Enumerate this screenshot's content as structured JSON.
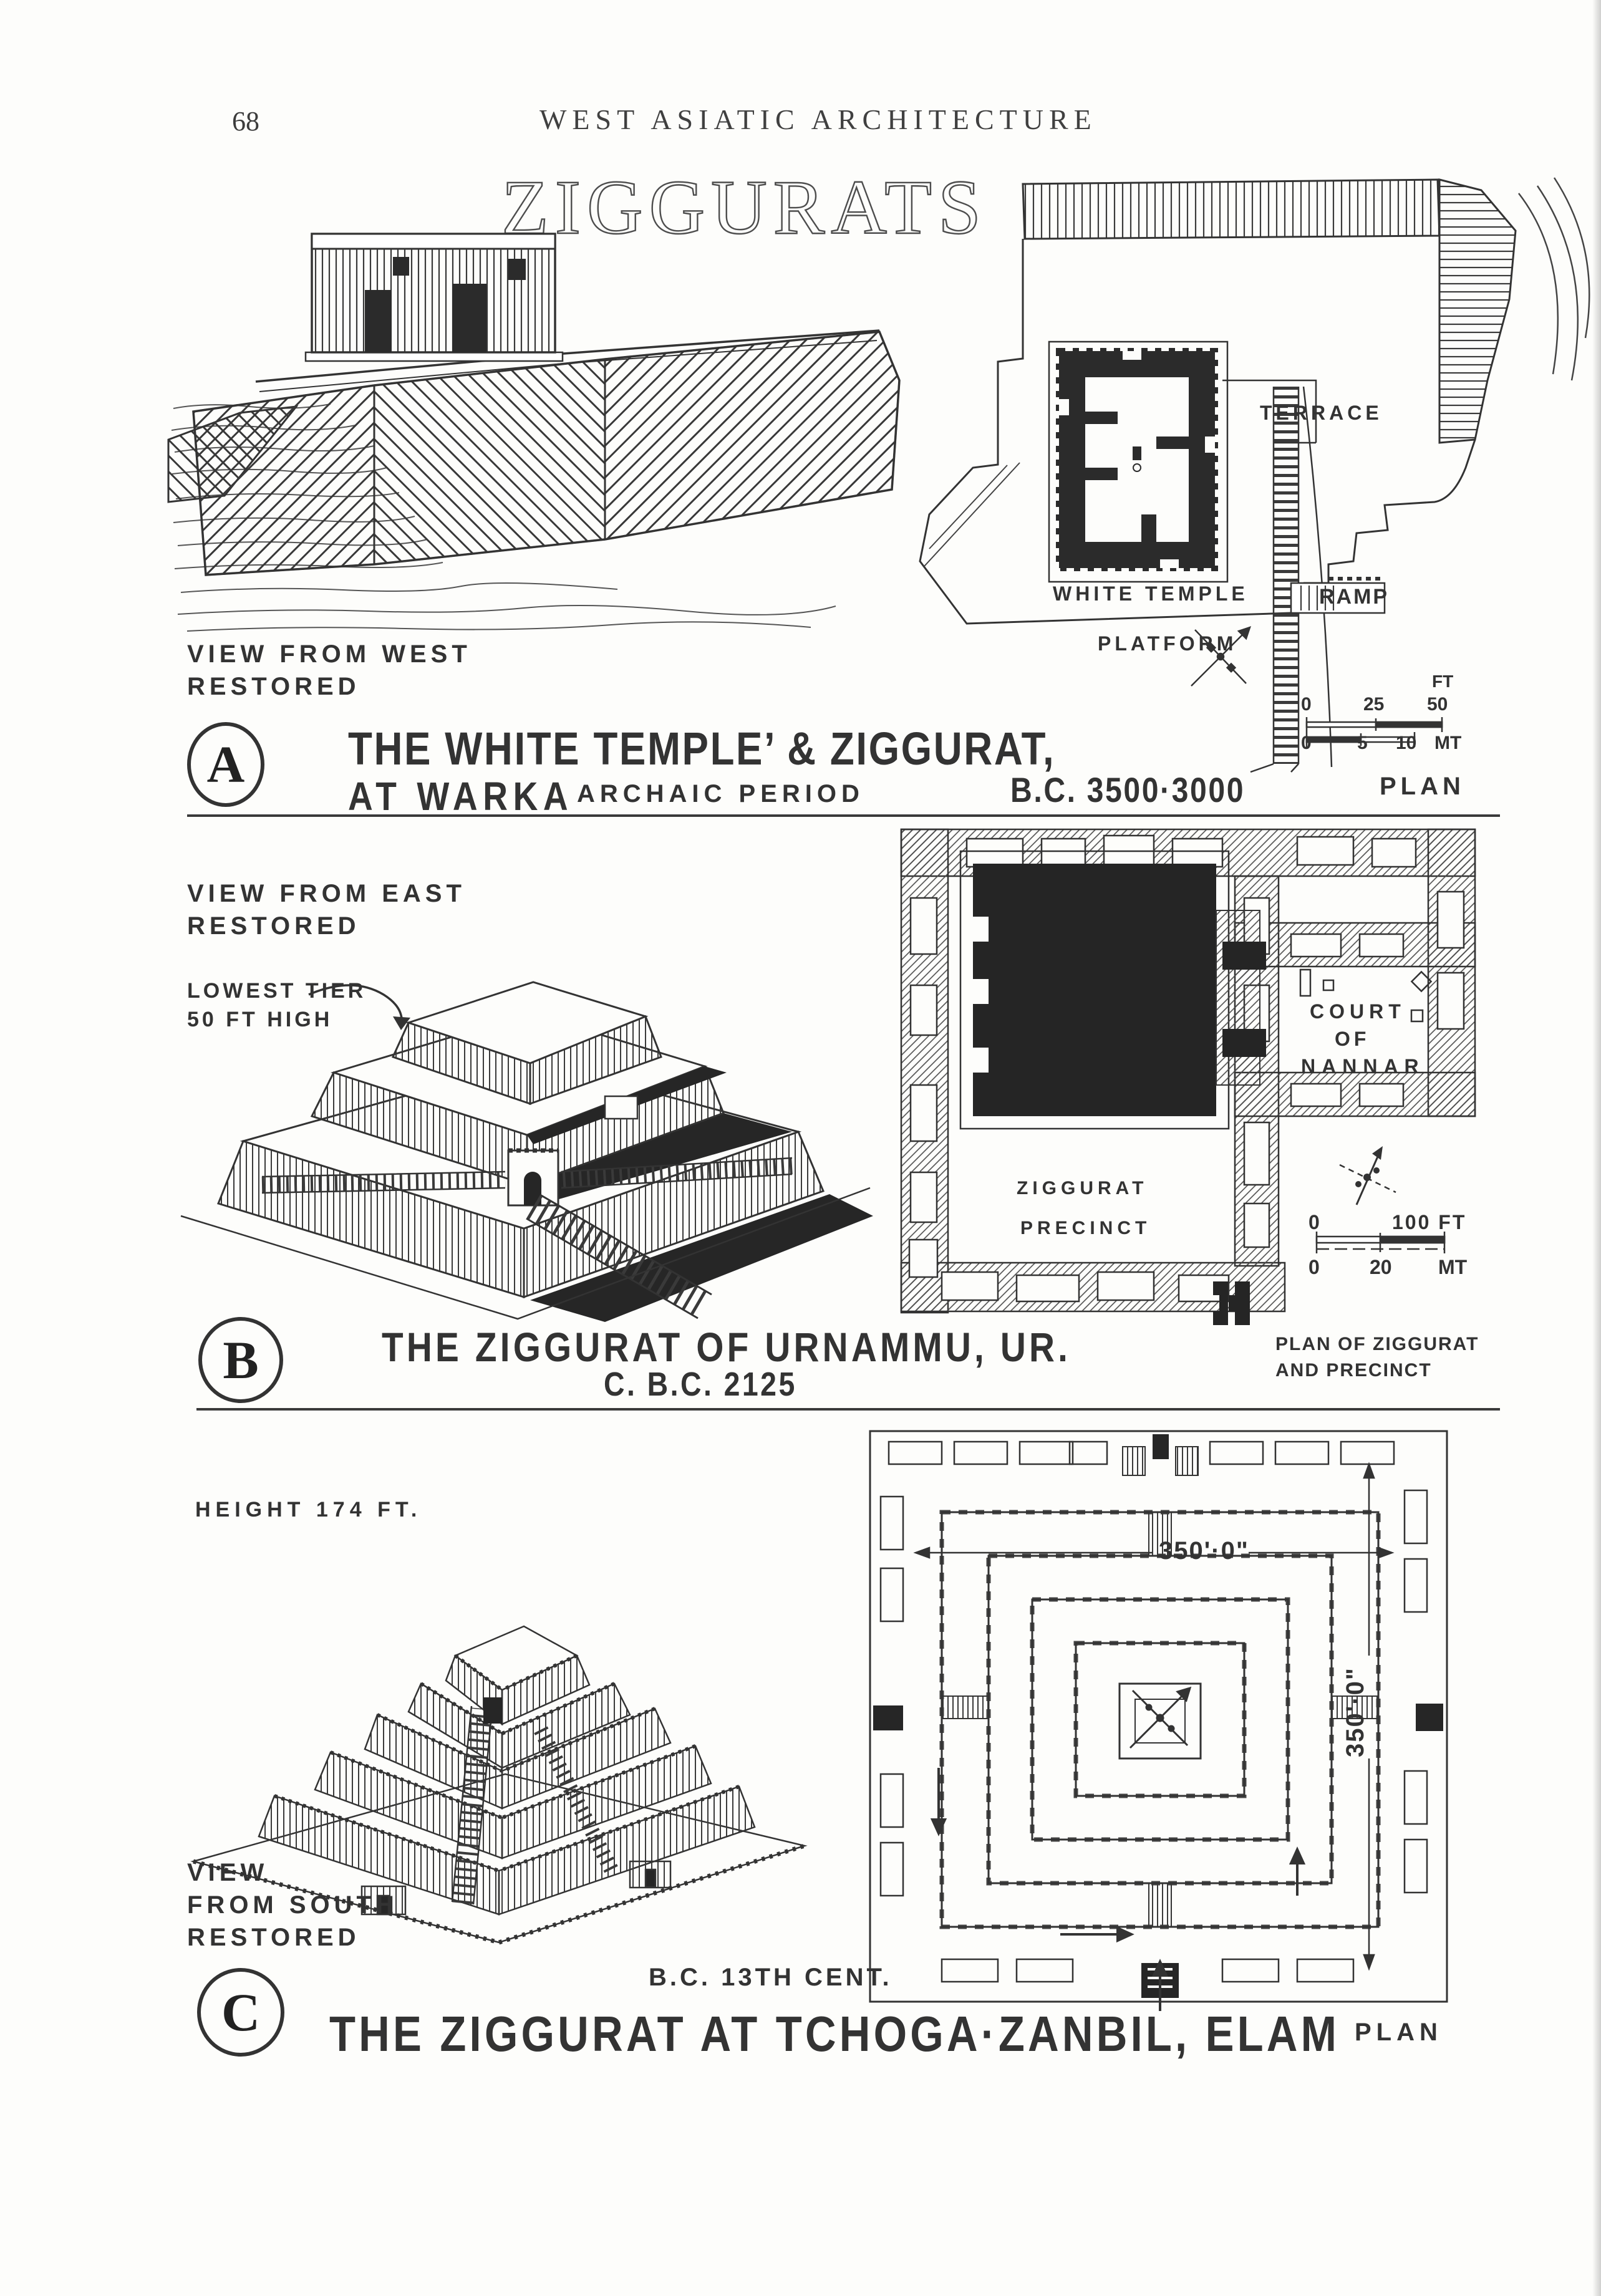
{
  "page": {
    "number": "68",
    "header": "WEST ASIATIC ARCHITECTURE",
    "title": "ZIGGURATS"
  },
  "section_a": {
    "badge": "A",
    "view_label": [
      "VIEW FROM WEST",
      "RESTORED"
    ],
    "caption": "THE WHITE TEMPLE’ & ZIGGURAT,",
    "caption_sub": "AT WARKA",
    "period": "ARCHAIC PERIOD",
    "date": "B.C. 3500·3000",
    "plan_title": "PLAN",
    "plan_labels": {
      "terrace": "TERRACE",
      "white_temple": "WHITE TEMPLE",
      "ramp": "RAMP",
      "platform": "PLATFORM"
    },
    "scale": {
      "unit_ft": "FT",
      "ft_ticks": [
        "0",
        "25",
        "50"
      ],
      "mt_ticks": [
        "0",
        "5",
        "10"
      ],
      "unit_mt": "MT"
    }
  },
  "section_b": {
    "badge": "B",
    "view_label": [
      "VIEW FROM EAST",
      "RESTORED"
    ],
    "tier_note": [
      "LOWEST TIER",
      "50 FT HIGH"
    ],
    "caption": "THE ZIGGURAT OF URNAMMU, UR.",
    "caption_sub": "C. B.C. 2125",
    "plan_note": [
      "PLAN OF ZIGGURAT",
      "AND PRECINCT"
    ],
    "plan_labels": {
      "court": [
        "COURT",
        "OF",
        "NANNAR"
      ],
      "ziggurat": "ZIGGURAT",
      "precinct": "PRECINCT"
    },
    "scale": {
      "ft0": "0",
      "ft100": "100 FT",
      "mt0": "0",
      "mt20": "20",
      "unit_mt": "MT"
    }
  },
  "section_c": {
    "badge": "C",
    "height_note": "HEIGHT 174 FT.",
    "view_label": [
      "VIEW",
      "FROM SOUTH",
      "RESTORED"
    ],
    "date_note": "B.C. 13TH CENT.",
    "caption": "THE ZIGGURAT AT TCHOGA·ZANBIL, ELAM",
    "plan_title": "PLAN",
    "dimensions": {
      "width": "350'·0\"",
      "height": "350'·0\""
    }
  }
}
